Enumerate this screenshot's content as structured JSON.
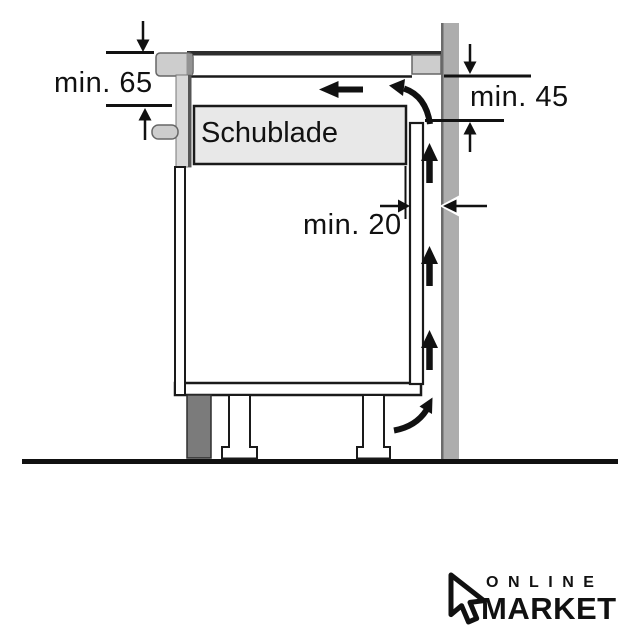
{
  "diagram": {
    "title_hint": "appliance installation clearance side-section diagram",
    "labels": {
      "dim_hob_depth": "min. 65",
      "dim_under_hob": "min. 45",
      "dim_rear_gap": "min. 20",
      "drawer": "Schublade"
    },
    "colors": {
      "line": "#111111",
      "wall_fill": "#adadad",
      "wall_edge": "#6b6b6b",
      "worktop_fill": "#cdcdcd",
      "drawer_fill": "#e8e8e8",
      "front_fill": "#d8d8d8",
      "plinth_fill": "#7b7b7b",
      "background": "#ffffff"
    }
  },
  "logo": {
    "line1": "ONLINE",
    "line2": "MARKET"
  }
}
